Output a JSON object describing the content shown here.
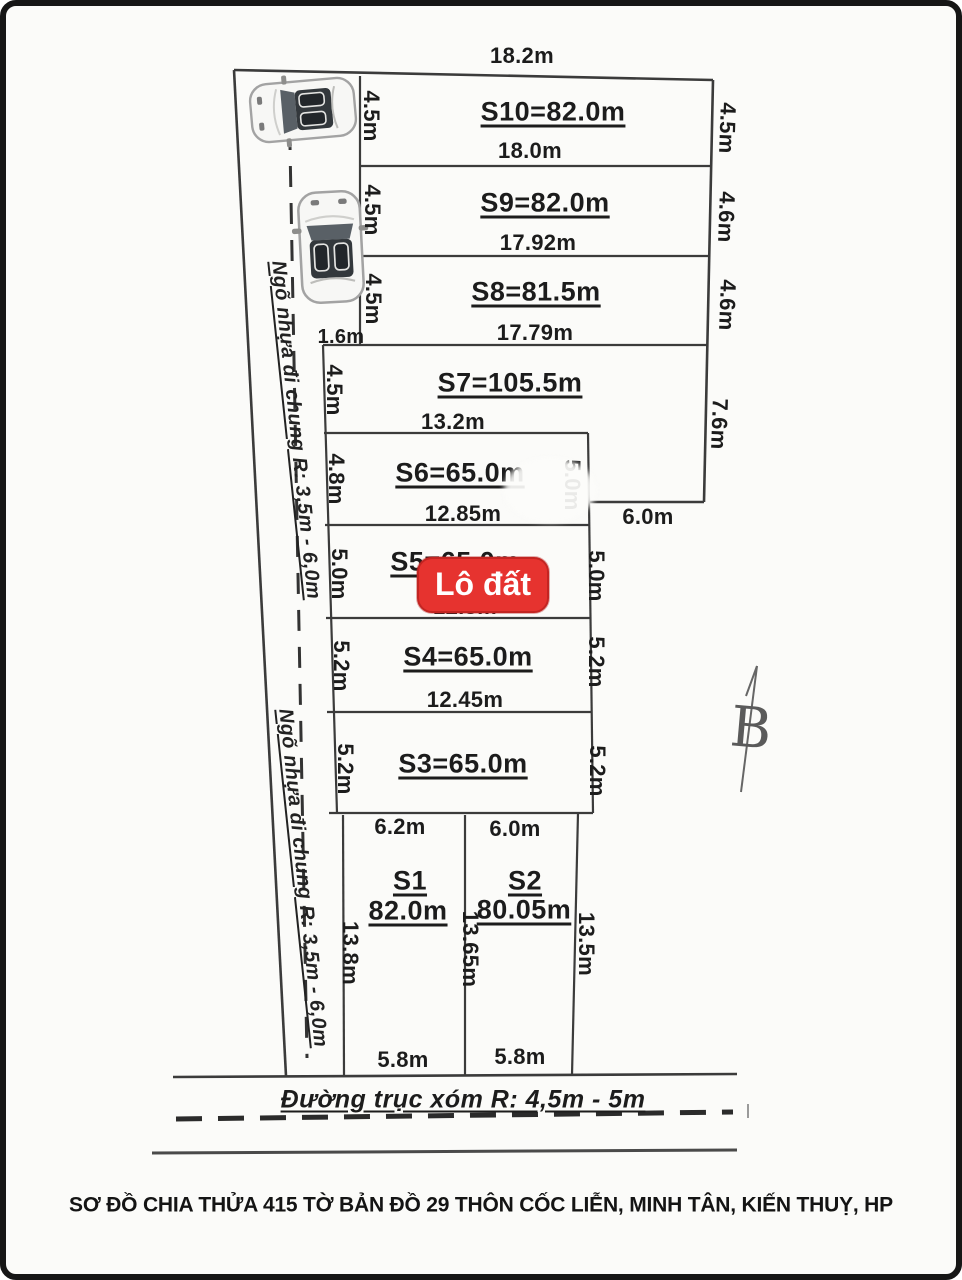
{
  "meta": {
    "caption": "SƠ ĐỒ CHIA THỬA 415 TỜ BẢN ĐỒ 29 THÔN CỐC LIỄN, MINH TÂN, KIẾN THUỴ, HP"
  },
  "overlay": {
    "badge": "Lô đất",
    "badge_color": "#e6332f"
  },
  "compass": {
    "label": "B"
  },
  "roads": {
    "alley": "Ngõ nhựa đi chung R: 3,5m - 6,0m",
    "main": "Đường trục xóm R: 4,5m - 5m"
  },
  "dims": {
    "top_width": "18.2m",
    "step_left": "1.6m",
    "step_right": "6.0m"
  },
  "plots": {
    "s10": {
      "name": "S10=82.0m",
      "bottom": "18.0m",
      "left": "4.5m",
      "right": "4.5m"
    },
    "s9": {
      "name": "S9=82.0m",
      "bottom": "17.92m",
      "left": "4.5m",
      "right": "4.6m"
    },
    "s8": {
      "name": "S8=81.5m",
      "bottom": "17.79m",
      "left": "4.5m",
      "right": "4.6m"
    },
    "s7": {
      "name": "S7=105.5m",
      "bottom": "13.2m",
      "left": "4.5m",
      "right": "7.6m"
    },
    "s6": {
      "name": "S6=65.0m",
      "bottom": "12.85m",
      "left": "4.8m",
      "right": "5.0m"
    },
    "s5": {
      "name": "S5=65.0m",
      "bottom": "12.5m",
      "left": "5.0m",
      "right": "5.0m"
    },
    "s4": {
      "name": "S4=65.0m",
      "bottom": "12.45m",
      "left": "5.2m",
      "right": "5.2m"
    },
    "s3": {
      "name": "S3=65.0m",
      "left": "5.2m",
      "right": "5.2m"
    },
    "s1": {
      "name": "S1",
      "area": "82.0m",
      "top": "6.2m",
      "bottom": "5.8m",
      "left": "13.8m",
      "mid": "13.65m"
    },
    "s2": {
      "name": "S2",
      "area": "80.05m",
      "top": "6.0m",
      "bottom": "5.8m",
      "right": "13.5m"
    }
  }
}
